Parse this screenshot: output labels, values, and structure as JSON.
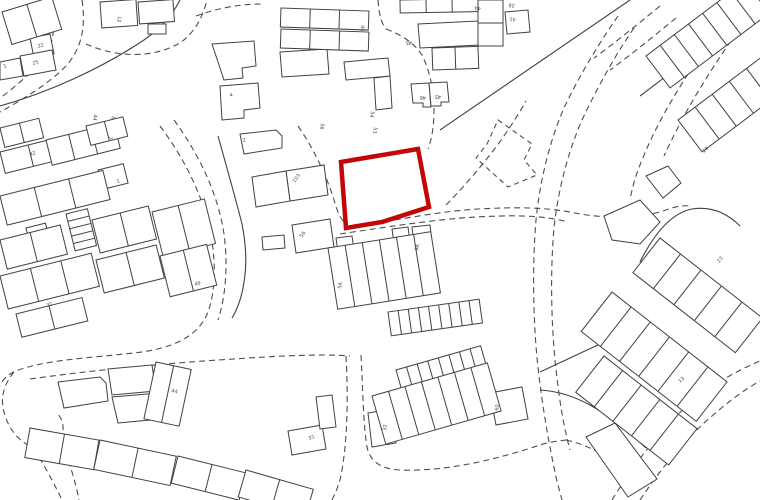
{
  "map": {
    "kind": "site-location-plan",
    "colors": {
      "background": "#ffffff",
      "building_line": "#414141",
      "road_line": "#4d4d4d",
      "site_boundary": "#c20606"
    },
    "site": {
      "points": "341,162 418,149 429,207 382,222 346,228"
    },
    "roads_dashed": [
      "M52,0 C56,26 54,46 42,60 C30,74 14,88 0,98",
      "M82,0 C86,26 82,50 64,68 C48,84 22,100 0,112",
      "M86,44 C118,58 152,58 178,44 C192,36 202,20 207,0",
      "M196,16 C218,8 240,4 262,4",
      "M160,126 C184,158 202,194 210,230 C216,260 216,290 208,312 C198,338 170,349 134,353 C88,358 44,360 16,371 C6,375 2,381 0,386",
      "M174,120 C200,156 218,194 224,234 C228,264 226,296 218,320",
      "M30,379 C94,370 168,363 234,359 C290,355 330,354 350,356",
      "M14,372 C4,384 0,398 4,412 C8,428 18,441 32,447 C44,451 56,447 61,437 C65,429 63,419 57,413",
      "M34,449 C44,465 54,483 62,500",
      "M61,442 C69,460 75,480 79,500",
      "M346,356 C348,392 348,434 342,470 C340,483 336,492 332,500",
      "M361,355 C363,390 363,422 367,447 C370,462 382,469 399,470 C446,472 498,459 540,445 C549,442 558,441 566,440",
      "M298,126 C312,146 326,174 334,200 C338,214 342,224 352,227 C392,221 440,211 478,209 C515,207 547,207 575,213 C606,219 640,219 666,210 C674,207 682,205 690,206",
      "M340,234 C386,227 438,219 476,217 C512,215 543,215 568,222",
      "M446,205 C462,189 480,168 496,147 C508,131 518,115 526,101",
      "M378,0 C379,12 380,21 386,29",
      "M386,29 C402,35 414,43 422,55 C430,71 434,91 434,111 C434,125 432,139 428,149",
      "M618,16 C600,42 580,74 564,108 C550,140 540,180 536,220 C532,268 533,328 539,376 C543,410 549,444 556,477 C558,485 560,493 562,500",
      "M634,28 C616,54 598,86 582,120 C568,152 558,190 554,228 C550,274 551,330 557,378 C560,404 564,428 570,450",
      "M740,0 C722,24 704,48 688,74 C670,102 654,130 642,160 C636,174 632,188 630,200",
      "M754,8 C738,30 720,56 704,82 C690,104 676,130 664,156",
      "M640,500 C660,470 684,440 712,416 C728,402 744,390 760,381",
      "M612,500 C634,464 660,430 690,403 C712,385 736,371 760,361",
      "M566,440 C584,444 600,452 613,462 C623,470 631,480 637,491",
      "M660,6 C638,24 616,42 594,58",
      "M676,18 C654,36 632,54 610,70"
    ],
    "roads_solid": [
      "M630,0 L440,130",
      "M0,106 C50,92 102,68 144,40 C158,30 172,16 180,0",
      "M218,136 C227,168 236,200 242,224 C246,244 247,264 244,282 C242,296 238,308 232,318",
      "M640,96 C680,66 720,34 758,4",
      "M540,372 L630,330",
      "M540,390 C580,392 614,418 646,448",
      "M640,262 C655,232 672,213 692,209 C712,206 728,214 740,226"
    ],
    "parcels_dashed": [
      "498,120 532,144 524,160 537,175 508,187 476,158 487,144"
    ],
    "buildings": [
      {
        "pts": "30,38 50,34 54,54 34,58"
      },
      {
        "pts": "20,56 52,50 56,70 24,76"
      },
      {
        "pts": "0,62 20,58 23,76 0,80"
      },
      {
        "pts": "148,24 166,24 166,34 148,34"
      },
      {
        "pts": "418,24 478,21 480,45 420,48"
      },
      {
        "pts": "411,84 429,83 431,107 423,107 423,103 413,103"
      },
      {
        "pts": "429,83 447,82 449,102 441,102 441,106 431,106"
      },
      {
        "pts": "505,12 528,10 530,32 507,34"
      },
      {
        "pts": "212,44 254,41 256,66 242,68 243,78 224,80"
      },
      {
        "pts": "280,52 327,49 329,74 282,77"
      },
      {
        "pts": "220,86 258,83 260,108 244,110 244,118 222,120"
      },
      {
        "pts": "240,134 276,130 282,136 282,148 244,154"
      },
      {
        "pts": "286,171 324,165 328,195 290,201"
      },
      {
        "pts": "252,177 286,171 290,201 256,207"
      },
      {
        "pts": "292,225 330,219 334,247 296,253"
      },
      {
        "pts": "262,237 284,235 285,248 263,250"
      },
      {
        "pts": "344,62 388,58 390,76 346,80"
      },
      {
        "pts": "374,78 390,76 392,108 376,110"
      },
      {
        "pts": "58,382 100,377 106,383 108,401 64,408"
      },
      {
        "pts": "108,369 152,365 156,391 112,395"
      },
      {
        "pts": "112,397 158,393 162,419 118,423"
      },
      {
        "pts": "288,431 322,425 326,449 292,455"
      },
      {
        "pts": "316,397 332,395 336,427 320,429"
      },
      {
        "pts": "336,238 352,236 354,250 338,252"
      },
      {
        "pts": "392,229 408,227 410,241 394,243"
      },
      {
        "pts": "412,227 430,225 432,243 414,245"
      },
      {
        "pts": "490,393 522,387 528,419 496,425"
      },
      {
        "pts": "368,413 392,409 396,443 372,447"
      },
      {
        "pts": "604,216 640,200 660,222 640,244 612,240"
      },
      {
        "pts": "646,176 668,166 681,183 663,198"
      },
      {
        "pts": "586,437 615,423 657,479 628,497"
      }
    ],
    "terraces": [
      {
        "x": 2,
        "y": 12,
        "w": 52,
        "h": 34,
        "angle": -17,
        "cells": 2
      },
      {
        "x": 100,
        "y": 2,
        "w": 36,
        "h": 26,
        "angle": -4,
        "cells": 1
      },
      {
        "x": 138,
        "y": 2,
        "w": 35,
        "h": 22,
        "angle": -4,
        "cells": 1
      },
      {
        "x": 281,
        "y": 8,
        "w": 88,
        "h": 19,
        "angle": 2,
        "cells": 3
      },
      {
        "x": 281,
        "y": 29,
        "w": 88,
        "h": 19,
        "angle": 2,
        "cells": 3
      },
      {
        "x": 400,
        "y": 0,
        "w": 78,
        "h": 13,
        "angle": -1,
        "cells": 3
      },
      {
        "x": 432,
        "y": 48,
        "w": 46,
        "h": 22,
        "angle": -2,
        "cells": 2
      },
      {
        "x": 478,
        "y": 0,
        "w": 25,
        "h": 46,
        "angle": 0,
        "cells": 1,
        "hcells": 2
      },
      {
        "x": 0,
        "y": 128,
        "w": 40,
        "h": 20,
        "angle": -14,
        "cells": 2
      },
      {
        "x": 0,
        "y": 152,
        "w": 58,
        "h": 22,
        "angle": -14,
        "cells": 2
      },
      {
        "x": 46,
        "y": 140,
        "w": 70,
        "h": 26,
        "angle": -14,
        "cells": 3
      },
      {
        "x": 86,
        "y": 126,
        "w": 38,
        "h": 20,
        "angle": -14,
        "cells": 2
      },
      {
        "x": 98,
        "y": 170,
        "w": 26,
        "h": 20,
        "angle": -14,
        "cells": 1
      },
      {
        "x": 0,
        "y": 196,
        "w": 106,
        "h": 30,
        "angle": -14,
        "cells": 3
      },
      {
        "x": 26,
        "y": 228,
        "w": 20,
        "h": 28,
        "angle": -14,
        "cells": 1,
        "hcells": 4
      },
      {
        "x": 66,
        "y": 214,
        "w": 22,
        "h": 38,
        "angle": -14,
        "cells": 1,
        "hcells": 5
      },
      {
        "x": 92,
        "y": 220,
        "w": 58,
        "h": 34,
        "angle": -14,
        "cells": 2
      },
      {
        "x": 152,
        "y": 212,
        "w": 54,
        "h": 46,
        "angle": -14,
        "cells": 2
      },
      {
        "x": 0,
        "y": 240,
        "w": 62,
        "h": 30,
        "angle": -14,
        "cells": 2
      },
      {
        "x": 0,
        "y": 276,
        "w": 94,
        "h": 34,
        "angle": -14,
        "cells": 3
      },
      {
        "x": 96,
        "y": 260,
        "w": 62,
        "h": 34,
        "angle": -14,
        "cells": 2
      },
      {
        "x": 160,
        "y": 256,
        "w": 48,
        "h": 42,
        "angle": -14,
        "cells": 2
      },
      {
        "x": 16,
        "y": 314,
        "w": 68,
        "h": 24,
        "angle": -14,
        "cells": 2
      },
      {
        "x": 156,
        "y": 362,
        "w": 36,
        "h": 58,
        "angle": 12,
        "cells": 2
      },
      {
        "x": 30,
        "y": 428,
        "w": 70,
        "h": 30,
        "angle": 10,
        "cells": 2
      },
      {
        "x": 100,
        "y": 440,
        "w": 78,
        "h": 30,
        "angle": 12,
        "cells": 2
      },
      {
        "x": 178,
        "y": 456,
        "w": 70,
        "h": 28,
        "angle": 14,
        "cells": 2
      },
      {
        "x": 246,
        "y": 470,
        "w": 70,
        "h": 28,
        "angle": 16,
        "cells": 2
      },
      {
        "x": 328,
        "y": 248,
        "w": 104,
        "h": 62,
        "angle": -9,
        "cells": 6
      },
      {
        "x": 388,
        "y": 312,
        "w": 92,
        "h": 24,
        "angle": -8,
        "cells": 9
      },
      {
        "x": 396,
        "y": 370,
        "w": 88,
        "h": 20,
        "angle": -16,
        "cells": 8
      },
      {
        "x": 372,
        "y": 396,
        "w": 120,
        "h": 50,
        "angle": -16,
        "cells": 7
      },
      {
        "x": 646,
        "y": 56,
        "w": 142,
        "h": 40,
        "angle": -37,
        "cells": 8
      },
      {
        "x": 678,
        "y": 120,
        "w": 150,
        "h": 40,
        "angle": -37,
        "cells": 7
      },
      {
        "x": 660,
        "y": 238,
        "w": 130,
        "h": 44,
        "angle": 38,
        "cells": 5
      },
      {
        "x": 612,
        "y": 292,
        "w": 146,
        "h": 50,
        "angle": 38,
        "cells": 6
      },
      {
        "x": 604,
        "y": 356,
        "w": 118,
        "h": 46,
        "angle": 38,
        "cells": 5
      }
    ],
    "labels": [
      {
        "t": "22",
        "x": 38,
        "y": 48,
        "r": -17
      },
      {
        "t": "25",
        "x": 33,
        "y": 65,
        "r": -17
      },
      {
        "t": "1",
        "x": 4,
        "y": 68,
        "r": -17
      },
      {
        "t": "12",
        "x": 118,
        "y": 16,
        "r": 96
      },
      {
        "t": "44",
        "x": 94,
        "y": 114,
        "r": 100
      },
      {
        "t": "8",
        "x": 112,
        "y": 116,
        "r": 100
      },
      {
        "t": "7",
        "x": 109,
        "y": 136,
        "r": 100
      },
      {
        "t": "42",
        "x": 30,
        "y": 156,
        "r": -17
      },
      {
        "t": "1",
        "x": 117,
        "y": 183,
        "r": -17
      },
      {
        "t": "49",
        "x": 195,
        "y": 286,
        "r": -17
      },
      {
        "t": "31",
        "x": 47,
        "y": 307,
        "r": -17
      },
      {
        "t": "4",
        "x": 230,
        "y": 97,
        "r": -15
      },
      {
        "t": "2",
        "x": 243,
        "y": 142,
        "r": -15
      },
      {
        "t": "103",
        "x": 295,
        "y": 183,
        "r": -55
      },
      {
        "t": "56",
        "x": 302,
        "y": 238,
        "r": -55
      },
      {
        "t": "56",
        "x": 321,
        "y": 123,
        "r": 100
      },
      {
        "t": "54",
        "x": 371,
        "y": 111,
        "r": 100
      },
      {
        "t": "53",
        "x": 374,
        "y": 127,
        "r": 100
      },
      {
        "t": "45",
        "x": 361,
        "y": 25,
        "r": 93
      },
      {
        "t": "44",
        "x": 481,
        "y": 7,
        "r": 185
      },
      {
        "t": "28",
        "x": 515,
        "y": 4,
        "r": 185
      },
      {
        "t": "41",
        "x": 516,
        "y": 18,
        "r": 185
      },
      {
        "t": "45",
        "x": 412,
        "y": 41,
        "r": 180
      },
      {
        "t": "46",
        "x": 426,
        "y": 96,
        "r": 180
      },
      {
        "t": "45",
        "x": 441,
        "y": 95,
        "r": 180
      },
      {
        "t": "9A",
        "x": 418,
        "y": 251,
        "r": -78
      },
      {
        "t": "5A",
        "x": 341,
        "y": 289,
        "r": -78
      },
      {
        "t": "32",
        "x": 386,
        "y": 431,
        "r": -80
      },
      {
        "t": "60",
        "x": 498,
        "y": 411,
        "r": -80
      },
      {
        "t": "31",
        "x": 309,
        "y": 440,
        "r": -20
      },
      {
        "t": "44",
        "x": 171,
        "y": 392,
        "r": 14
      },
      {
        "t": "23",
        "x": 719,
        "y": 263,
        "r": -48
      },
      {
        "t": "13",
        "x": 680,
        "y": 383,
        "r": -42
      },
      {
        "t": "10",
        "x": 704,
        "y": 153,
        "r": -42
      }
    ]
  }
}
